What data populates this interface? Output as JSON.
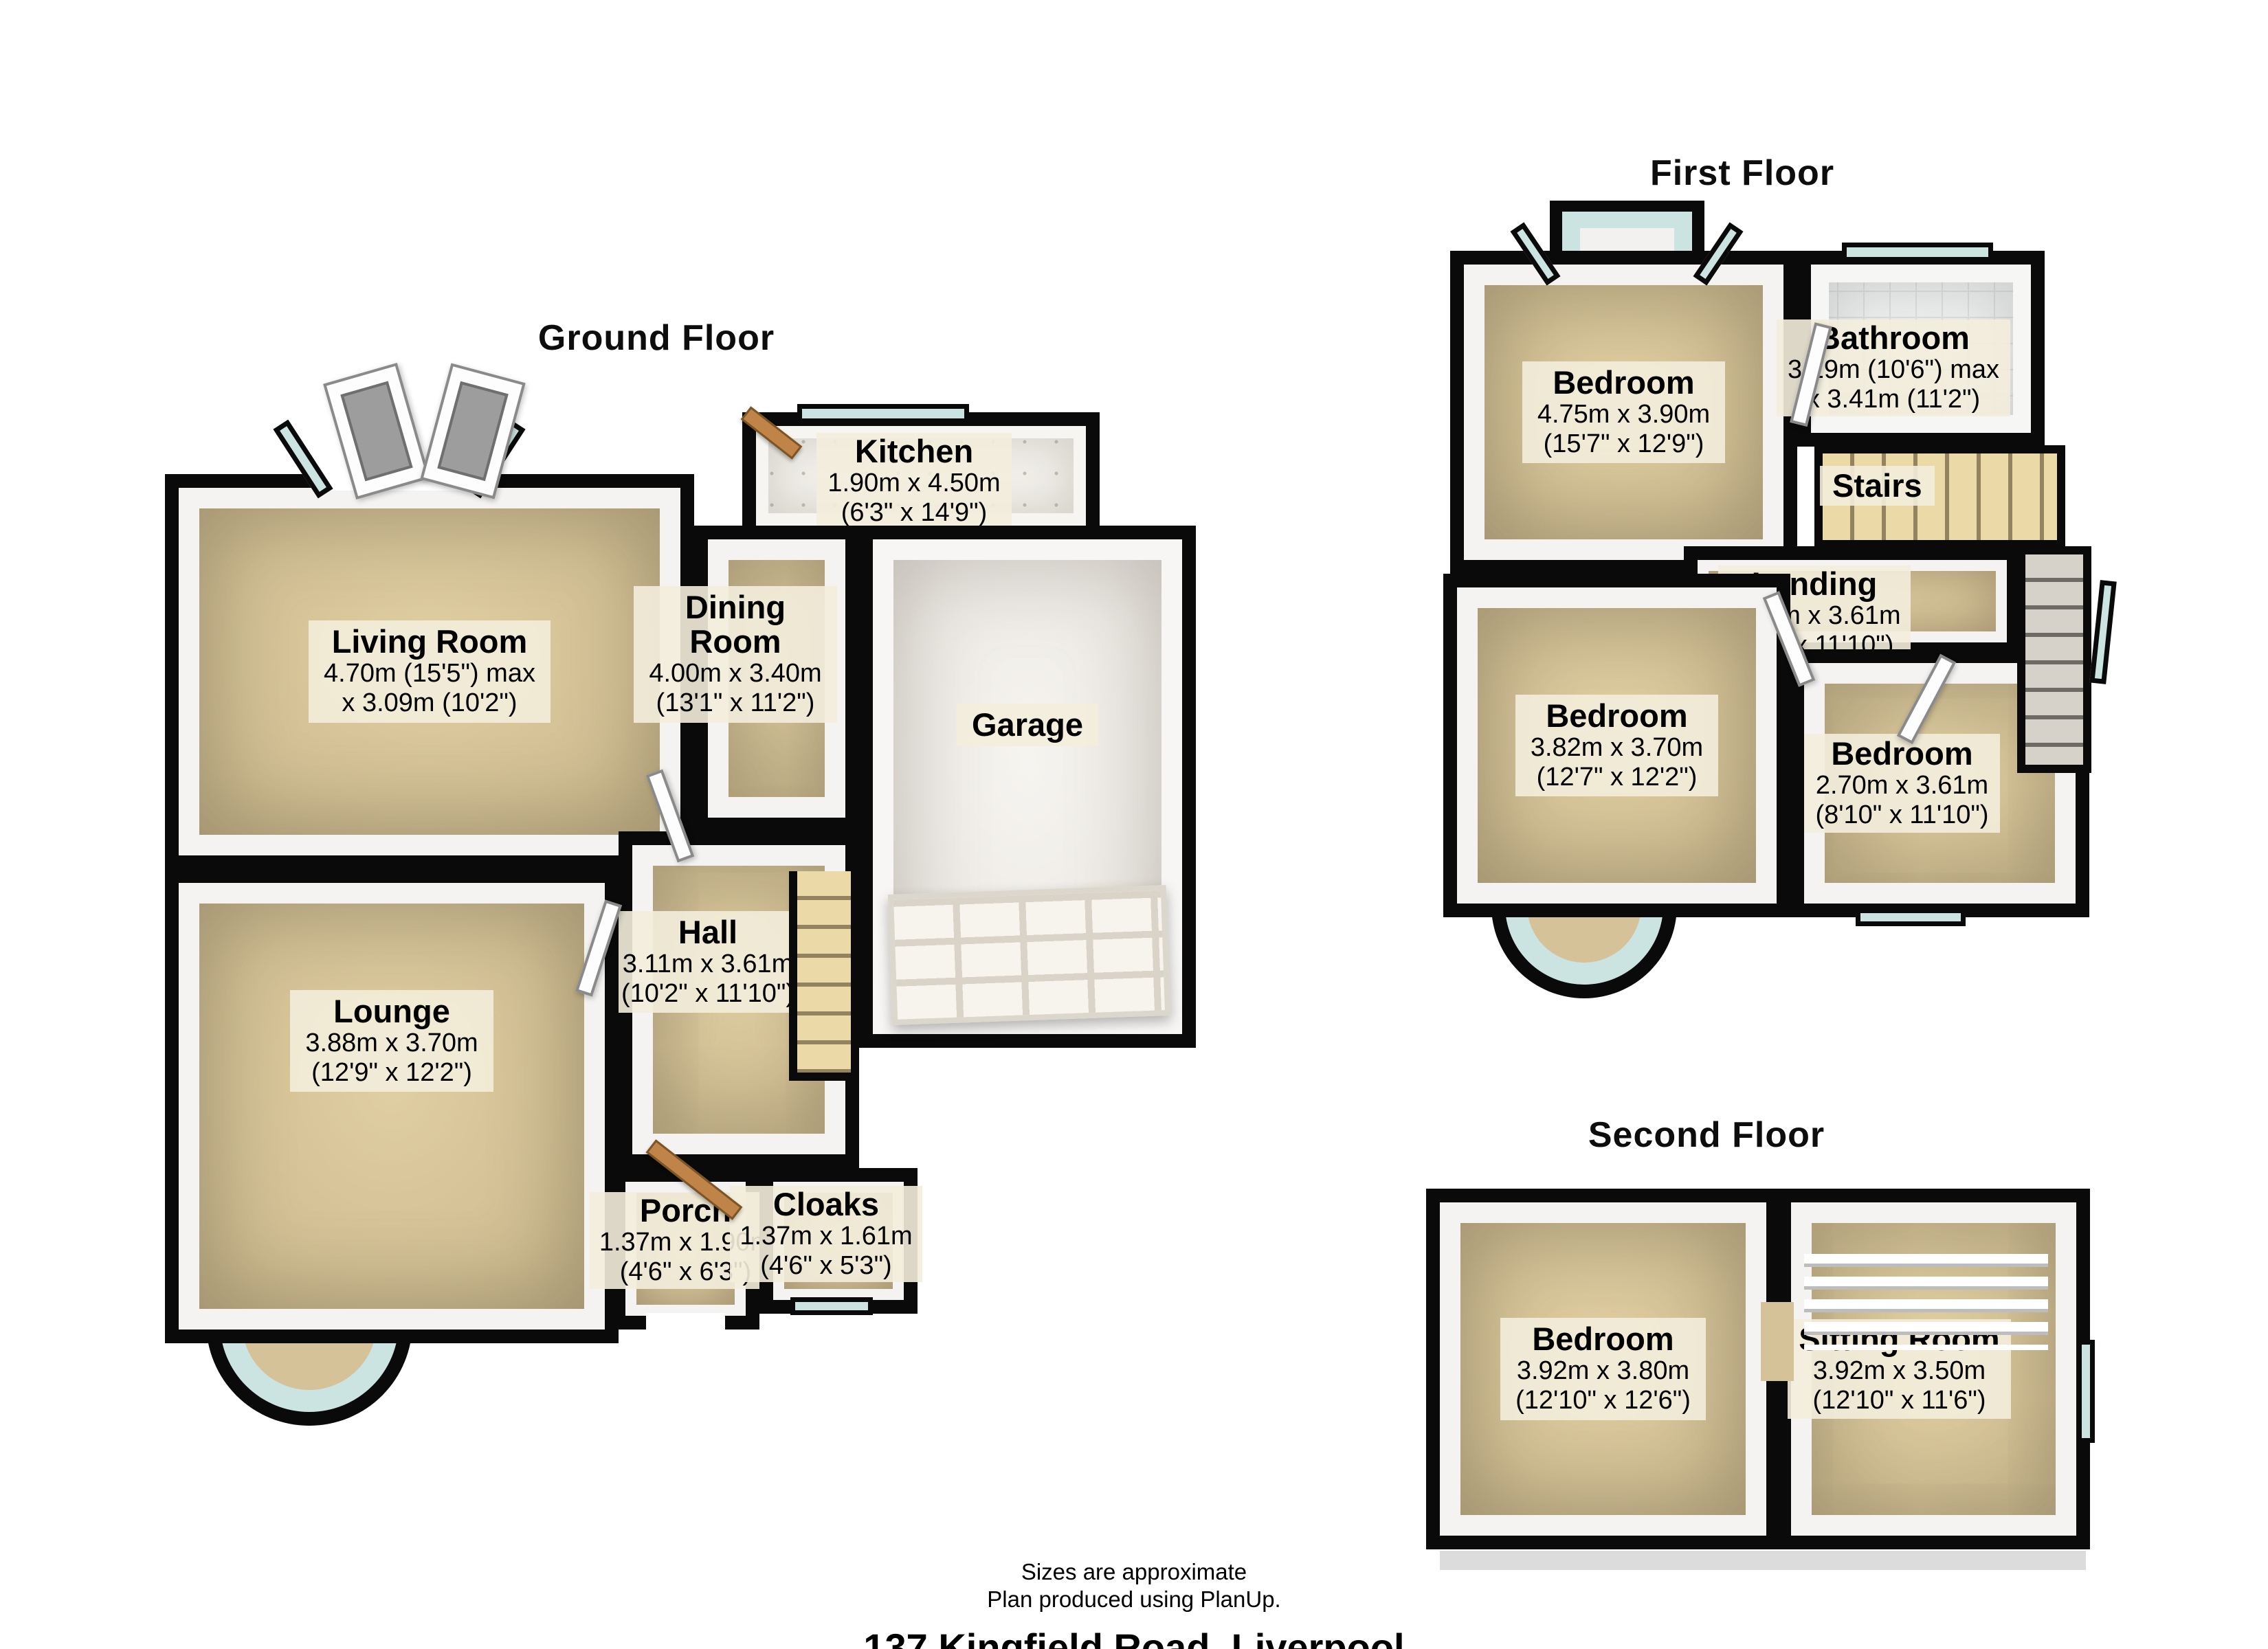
{
  "meta": {
    "plan_type": "3D floor plan"
  },
  "colors": {
    "floor": "#d5c298",
    "wall": "#0a0a0a",
    "glass": "#cbe4e2",
    "label_bg": "#f3eddc",
    "garage_floor": "#f1efeb"
  },
  "floors": [
    {
      "title": "Ground Floor",
      "rooms": [
        {
          "key": "living-room",
          "name": "Living Room",
          "dim1": "4.70m (15'5\") max",
          "dim2": "x 3.09m (10'2\")"
        },
        {
          "key": "dining-room",
          "name": "Dining Room",
          "dim1": "4.00m x 3.40m",
          "dim2": "(13'1\" x 11'2\")"
        },
        {
          "key": "kitchen",
          "name": "Kitchen",
          "dim1": "1.90m x 4.50m",
          "dim2": "(6'3\" x 14'9\")"
        },
        {
          "key": "garage",
          "name": "Garage"
        },
        {
          "key": "hall",
          "name": "Hall",
          "dim1": "3.11m x 3.61m",
          "dim2": "(10'2\" x 11'10\")"
        },
        {
          "key": "lounge",
          "name": "Lounge",
          "dim1": "3.88m x 3.70m",
          "dim2": "(12'9\" x 12'2\")"
        },
        {
          "key": "porch",
          "name": "Porch",
          "dim1": "1.37m x 1.90m",
          "dim2": "(4'6\" x 6'3\")"
        },
        {
          "key": "cloaks",
          "name": "Cloaks",
          "dim1": "1.37m x 1.61m",
          "dim2": "(4'6\" x 5'3\")"
        }
      ]
    },
    {
      "title": "First Floor",
      "rooms": [
        {
          "key": "bedroom-1",
          "name": "Bedroom",
          "dim1": "4.75m x 3.90m",
          "dim2": "(15'7\" x 12'9\")"
        },
        {
          "key": "bathroom",
          "name": "Bathroom",
          "dim1": "3.19m (10'6\") max",
          "dim2": "x 3.41m (11'2\")"
        },
        {
          "key": "stairs",
          "name": "Stairs"
        },
        {
          "key": "landing",
          "name": "Landing",
          "dim1": "1.43m x 3.61m",
          "dim2": "(4'8\" x 11'10\")"
        },
        {
          "key": "bedroom-2",
          "name": "Bedroom",
          "dim1": "3.82m x 3.70m",
          "dim2": "(12'7\" x 12'2\")"
        },
        {
          "key": "bedroom-3",
          "name": "Bedroom",
          "dim1": "2.70m x 3.61m",
          "dim2": "(8'10\" x 11'10\")"
        }
      ]
    },
    {
      "title": "Second Floor",
      "rooms": [
        {
          "key": "bedroom",
          "name": "Bedroom",
          "dim1": "3.92m x 3.80m",
          "dim2": "(12'10\" x 12'6\")"
        },
        {
          "key": "sitting-room",
          "name": "Sitting Room",
          "dim1": "3.92m x 3.50m",
          "dim2": "(12'10\" x 11'6\")"
        }
      ]
    }
  ],
  "footer": {
    "approx": "Sizes are approximate",
    "produced": "Plan produced using PlanUp.",
    "address": "137 Kingfield Road, Liverpool"
  }
}
